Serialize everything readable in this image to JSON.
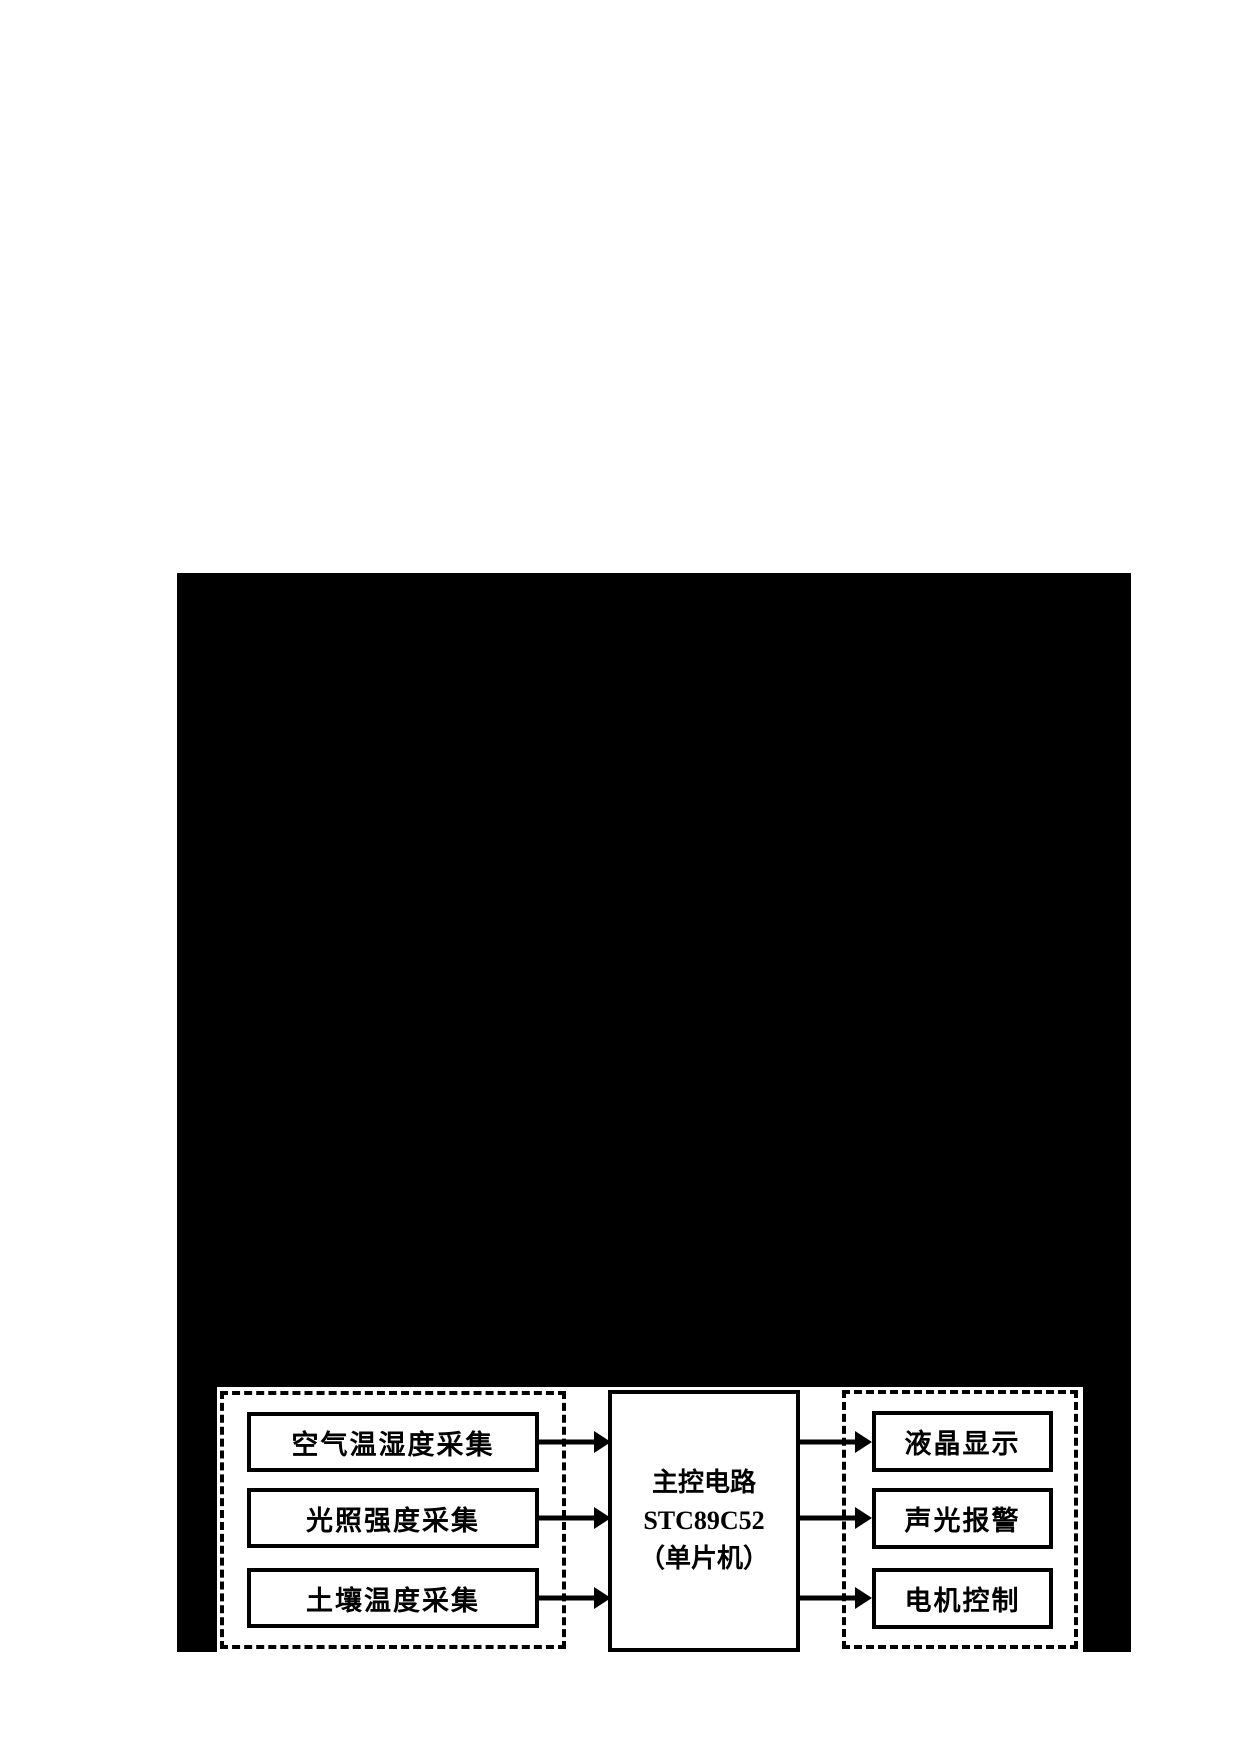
{
  "diagram": {
    "left_group": {
      "boxes": [
        {
          "label": "空气温湿度采集"
        },
        {
          "label": "光照强度采集"
        },
        {
          "label": "土壤温度采集"
        }
      ]
    },
    "center_box": {
      "lines": [
        "主控电路",
        "STC89C52",
        "（单片机）"
      ]
    },
    "right_group": {
      "boxes": [
        {
          "label": "液晶显示"
        },
        {
          "label": "声光报警"
        },
        {
          "label": "电机控制"
        }
      ]
    },
    "connections": [
      {
        "from": "空气温湿度采集",
        "to": "主控电路 STC89C52（单片机）"
      },
      {
        "from": "光照强度采集",
        "to": "主控电路 STC89C52（单片机）"
      },
      {
        "from": "土壤温度采集",
        "to": "主控电路 STC89C52（单片机）"
      },
      {
        "from": "主控电路 STC89C52（单片机）",
        "to": "液晶显示"
      },
      {
        "from": "主控电路 STC89C52（单片机）",
        "to": "声光报警"
      },
      {
        "from": "主控电路 STC89C52（单片机）",
        "to": "电机控制"
      }
    ],
    "colors": {
      "ink": "#000000",
      "paper": "#ffffff"
    }
  }
}
